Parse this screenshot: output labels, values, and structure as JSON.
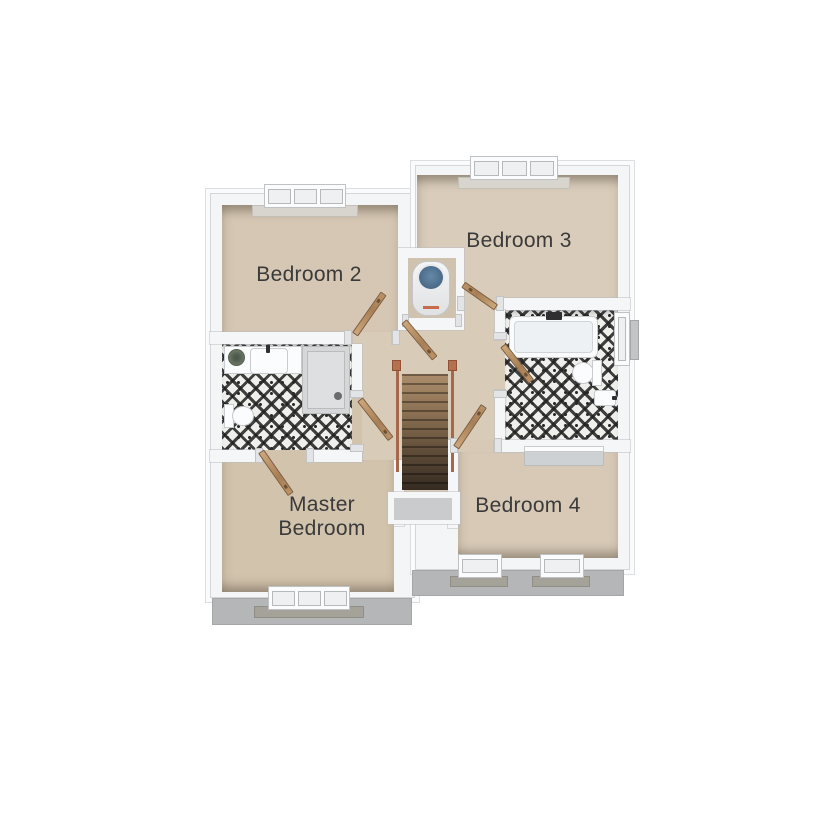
{
  "floor_plan": {
    "rooms": {
      "bedroom2": {
        "label": "Bedroom 2"
      },
      "bedroom3": {
        "label": "Bedroom 3"
      },
      "bedroom4": {
        "label": "Bedroom 4"
      },
      "master": {
        "label_line1": "Master",
        "label_line2": "Bedroom"
      }
    },
    "fixtures": [
      "bath",
      "shower",
      "wash-basin",
      "vanity-unit",
      "toilet",
      "plant",
      "hot-water-cylinder",
      "staircase",
      "wardrobe",
      "windows"
    ],
    "colors": {
      "floor_beige": "#d6c8b4",
      "landing_beige": "#d8cbb8",
      "wall_white": "#f5f6f7",
      "eaves_gray": "#b4b6b8",
      "tile_black": "#2a2a2a",
      "tile_white": "#efefec",
      "door_wood": "#bd9569",
      "stair_wood": "#8a6f52",
      "railing_copper": "#a5684a",
      "cylinder_blue": "#51708d",
      "label_text": "#3a3a3a"
    }
  }
}
